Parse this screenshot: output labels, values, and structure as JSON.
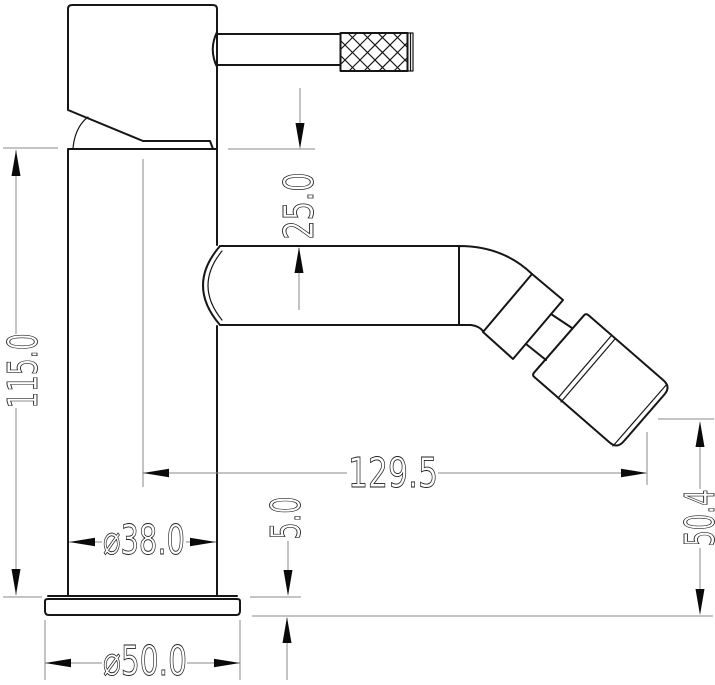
{
  "dimensions": {
    "total_height": "115.0",
    "spout_top_offset": "25.0",
    "spout_reach": "129.5",
    "outlet_height": "50.4",
    "base_thickness": "5.0",
    "body_diameter": "⌀38.0",
    "base_diameter": "⌀50.0"
  }
}
